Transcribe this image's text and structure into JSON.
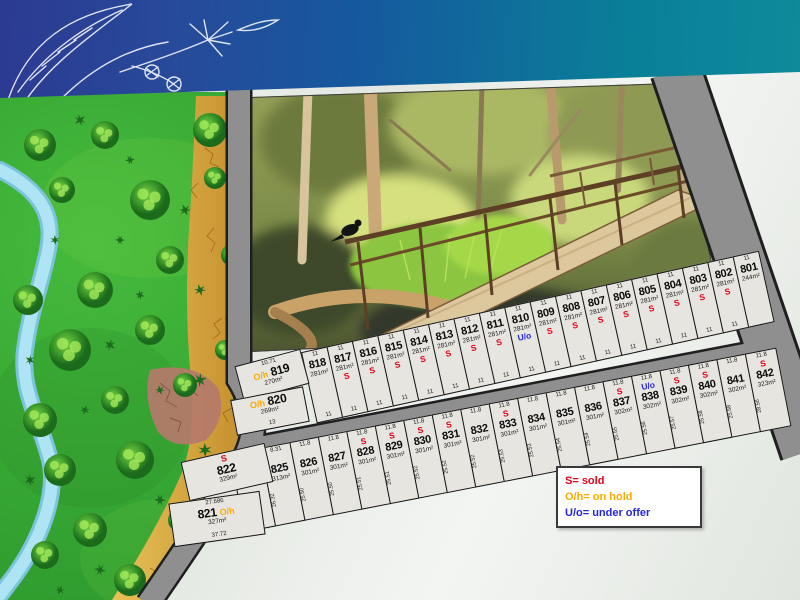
{
  "banner": {
    "illustration": "eucalyptus-branch-sketch",
    "gradient_start": "#2c3a92",
    "gradient_end": "#0e8a9b"
  },
  "photo": {
    "subject": "bushland creek with timber footbridge and bird on handrail"
  },
  "legend": {
    "items": [
      {
        "text": "S= sold",
        "color": "#e50019"
      },
      {
        "text": "O/h= on hold",
        "color": "#ffaa00"
      },
      {
        "text": "U/o= under offer",
        "color": "#2424ee"
      }
    ]
  },
  "status_colors": {
    "S": "#e50019",
    "O/h": "#ffaa00",
    "U/o": "#2424ee"
  },
  "colors": {
    "road": "#8f8f8f",
    "road_outline": "#1f1f1f",
    "lot_fill": "#e6e5e0",
    "lot_border": "#141414",
    "map_green": "#37a834",
    "river": "#aee4f4",
    "sand": "#d9a83e",
    "background": "#eaede8"
  },
  "lots": {
    "row1": [
      {
        "number": "801",
        "area": "244m²",
        "status": null,
        "dims": {
          "top": "11"
        }
      },
      {
        "number": "802",
        "area": "281m²",
        "status": "S",
        "dims": {
          "top": "11",
          "bottom": "11"
        }
      },
      {
        "number": "803",
        "area": "281m²",
        "status": "S",
        "dims": {
          "top": "11",
          "bottom": "11"
        }
      },
      {
        "number": "804",
        "area": "281m²",
        "status": "S",
        "dims": {
          "top": "11",
          "bottom": "11"
        }
      },
      {
        "number": "805",
        "area": "281m²",
        "status": "S",
        "dims": {
          "top": "11",
          "bottom": "11"
        }
      },
      {
        "number": "806",
        "area": "281m²",
        "status": "S",
        "dims": {
          "top": "11",
          "bottom": "11"
        }
      },
      {
        "number": "807",
        "area": "281m²",
        "status": "S",
        "dims": {
          "top": "11",
          "bottom": "11"
        }
      },
      {
        "number": "808",
        "area": "281m²",
        "status": "S",
        "dims": {
          "top": "11",
          "bottom": "11"
        }
      },
      {
        "number": "809",
        "area": "281m²",
        "status": "S",
        "dims": {
          "top": "11",
          "bottom": "11"
        }
      },
      {
        "number": "810",
        "area": "281m²",
        "status": "U/o",
        "dims": {
          "top": "11",
          "bottom": "11"
        }
      },
      {
        "number": "811",
        "area": "281m²",
        "status": "S",
        "dims": {
          "top": "11",
          "bottom": "11"
        }
      },
      {
        "number": "812",
        "area": "281m²",
        "status": "S",
        "dims": {
          "top": "11",
          "bottom": "11"
        }
      },
      {
        "number": "813",
        "area": "281m²",
        "status": "S",
        "dims": {
          "top": "11",
          "bottom": "11"
        }
      },
      {
        "number": "814",
        "area": "281m²",
        "status": "S",
        "dims": {
          "top": "11",
          "bottom": "11"
        }
      },
      {
        "number": "815",
        "area": "281m²",
        "status": "S",
        "dims": {
          "top": "11",
          "bottom": "11"
        }
      },
      {
        "number": "816",
        "area": "281m²",
        "status": "S",
        "dims": {
          "top": "11",
          "bottom": "11"
        }
      },
      {
        "number": "817",
        "area": "281m²",
        "status": "S",
        "dims": {
          "top": "11",
          "bottom": "11"
        }
      },
      {
        "number": "818",
        "area": "281m²",
        "status": null,
        "dims": {
          "top": "11",
          "bottom": "11"
        }
      },
      {
        "number": "819",
        "area": "270m²",
        "status": "O/h",
        "custom": true,
        "dims": {
          "top": "10.71",
          "side": "12.63"
        }
      },
      {
        "number": "820",
        "area": "269m²",
        "status": "O/h",
        "custom": true,
        "dims": {
          "bottom": "13",
          "side": "12.91"
        }
      }
    ],
    "row2": [
      {
        "number": "821",
        "area": "327m²",
        "status": "O/h",
        "custom": true,
        "dims": {
          "top": "27.686",
          "bottom": "37.72",
          "side": "11.37"
        }
      },
      {
        "number": "822",
        "area": "329m²",
        "status": "S",
        "custom": true,
        "dims": {
          "side": "24.53"
        }
      },
      {
        "number": "823",
        "area": "327m²",
        "status": "O/h",
        "dims": {
          "top": "4.579",
          "side": "28.94"
        }
      },
      {
        "number": "824",
        "area": "324m²",
        "status": null,
        "dims": {
          "top": "11.8",
          "side": "24.36"
        }
      },
      {
        "number": "825",
        "area": "313m²",
        "status": null,
        "dims": {
          "top": "8.31",
          "side": "26.32"
        }
      },
      {
        "number": "826",
        "area": "301m²",
        "status": null,
        "dims": {
          "top": "11.8",
          "side": "25.50"
        }
      },
      {
        "number": "827",
        "area": "301m²",
        "status": null,
        "dims": {
          "top": "11.8",
          "side": "25.50"
        }
      },
      {
        "number": "828",
        "area": "301m²",
        "status": "S",
        "dims": {
          "top": "11.8",
          "side": "25.51"
        }
      },
      {
        "number": "829",
        "area": "301m²",
        "status": "S",
        "dims": {
          "top": "11.8",
          "side": "25.51"
        }
      },
      {
        "number": "830",
        "area": "301m²",
        "status": "S",
        "dims": {
          "top": "11.8",
          "side": "25.52"
        }
      },
      {
        "number": "831",
        "area": "301m²",
        "status": "S",
        "dims": {
          "top": "11.8",
          "side": "25.52"
        }
      },
      {
        "number": "832",
        "area": "301m²",
        "status": null,
        "dims": {
          "top": "11.8",
          "side": "25.52"
        }
      },
      {
        "number": "833",
        "area": "301m²",
        "status": "S",
        "dims": {
          "top": "11.8",
          "side": "25.53"
        }
      },
      {
        "number": "834",
        "area": "301m²",
        "status": null,
        "dims": {
          "top": "11.8",
          "side": "25.53"
        }
      },
      {
        "number": "835",
        "area": "301m²",
        "status": null,
        "dims": {
          "top": "11.8",
          "side": "25.54"
        }
      },
      {
        "number": "836",
        "area": "301m²",
        "status": null,
        "dims": {
          "top": "11.8",
          "side": "25.54"
        }
      },
      {
        "number": "837",
        "area": "302m²",
        "status": "S",
        "dims": {
          "top": "11.8",
          "side": "25.55"
        }
      },
      {
        "number": "838",
        "area": "302m²",
        "status": "U/o",
        "dims": {
          "top": "11.8",
          "side": "25.56"
        }
      },
      {
        "number": "839",
        "area": "302m²",
        "status": "S",
        "dims": {
          "top": "11.8",
          "side": "25.57"
        }
      },
      {
        "number": "840",
        "area": "302m²",
        "status": "S",
        "dims": {
          "top": "11.8",
          "side": "25.58"
        }
      },
      {
        "number": "841",
        "area": "302m²",
        "status": null,
        "dims": {
          "top": "11.8",
          "side": "25.58"
        }
      },
      {
        "number": "842",
        "area": "323m²",
        "status": "S",
        "dims": {
          "top": "11.8",
          "side": "28.56"
        }
      }
    ]
  }
}
